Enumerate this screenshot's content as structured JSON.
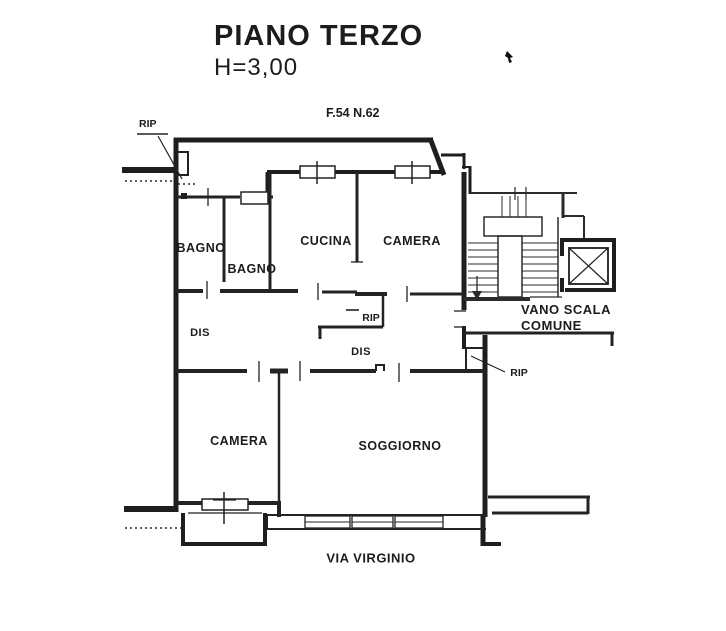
{
  "header": {
    "title": "PIANO TERZO",
    "height_note": "H=3,00"
  },
  "plan": {
    "cadastral_ref": "F.54 N.62",
    "street_label": "VIA VIRGINIO",
    "stairwell": {
      "line1": "VANO SCALA",
      "line2": "COMUNE"
    },
    "rooms": [
      {
        "id": "bagno-1",
        "label": "BAGNO"
      },
      {
        "id": "bagno-2",
        "label": "BAGNO"
      },
      {
        "id": "cucina",
        "label": "CUCINA"
      },
      {
        "id": "camera-nord",
        "label": "CAMERA"
      },
      {
        "id": "dis-ovest",
        "label": "DIS"
      },
      {
        "id": "rip-centro",
        "label": "RIP"
      },
      {
        "id": "dis-centro",
        "label": "DIS"
      },
      {
        "id": "camera-sud",
        "label": "CAMERA"
      },
      {
        "id": "soggiorno",
        "label": "SOGGIORNO"
      }
    ],
    "annotations": [
      {
        "id": "rip-nordovest",
        "label": "RIP"
      },
      {
        "id": "rip-est",
        "label": "RIP"
      }
    ],
    "colors": {
      "ink": "#1c1c1c",
      "paper": "#ffffff"
    }
  }
}
